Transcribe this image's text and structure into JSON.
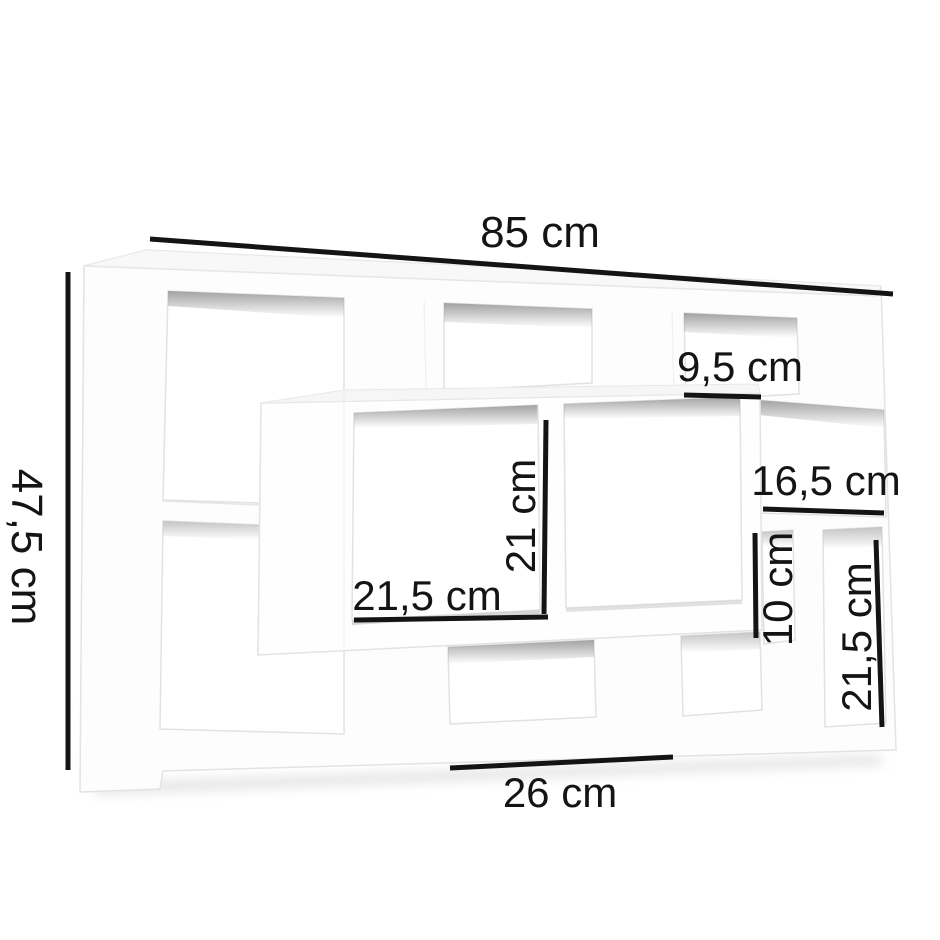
{
  "page": {
    "type": "product dimension diagram",
    "subject": "white wall-mounted floating cube shelf",
    "background": "#ffffff"
  },
  "colors": {
    "annotation": "#141414",
    "shelf_white": "#fdfdfd",
    "top_face_gray": "#f6f6f6",
    "edge_gray": "#e5e5e5",
    "interior_shade_gray": "#a8a8a8",
    "shadow_gray": "#dedede"
  },
  "annotations": {
    "width": {
      "label": "85 cm"
    },
    "height": {
      "label": "47,5 cm"
    },
    "top_right_opening": {
      "label": "9,5 cm"
    },
    "right_middle_opening": {
      "label": "16,5 cm"
    },
    "center_opening_height": {
      "label": "21 cm"
    },
    "center_opening_width": {
      "label": "21,5 cm"
    },
    "right_lower_opening": {
      "label": "10 cm"
    },
    "bottom_right_opening": {
      "label": "21,5 cm"
    },
    "bottom_middle_opening": {
      "label": "26 cm"
    }
  }
}
